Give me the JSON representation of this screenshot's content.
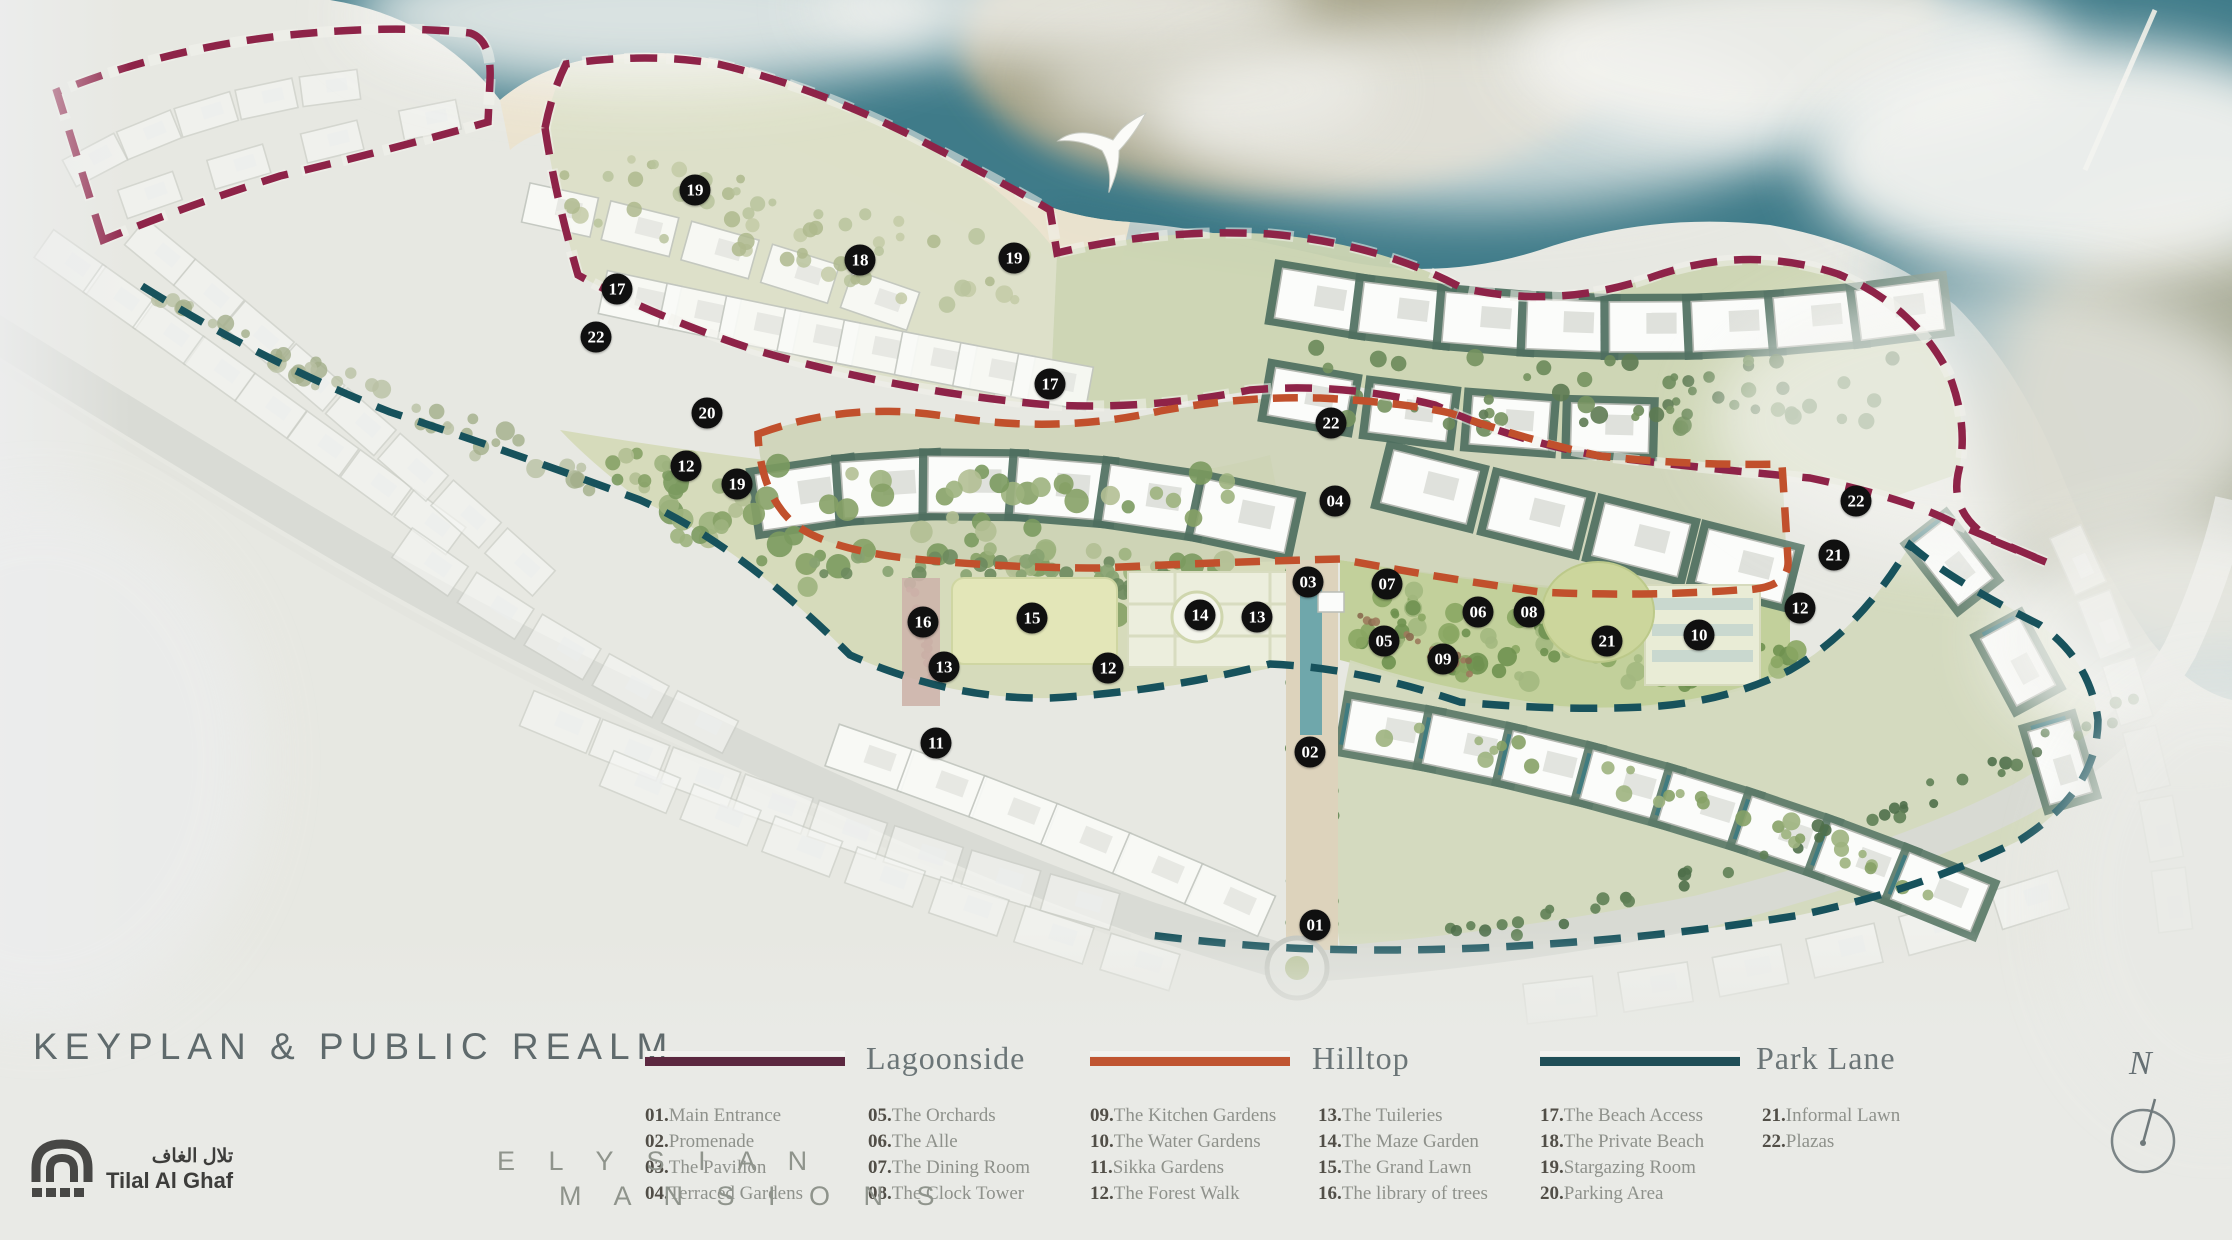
{
  "title": "KEYPLAN & PUBLIC REALM",
  "brand": {
    "logo_arabic": "تلال الغاف",
    "logo_name": "Tilal Al Ghaf",
    "project_line1": "E L Y S I A N",
    "project_line2": "M A N S I O N S"
  },
  "compass": {
    "label": "N"
  },
  "legend": {
    "groups": [
      {
        "id": "lagoonside",
        "name": "Lagoonside",
        "color": "#5c2840",
        "map_color": "#8e2348"
      },
      {
        "id": "hilltop",
        "name": "Hilltop",
        "color": "#c05531",
        "map_color": "#c1502c"
      },
      {
        "id": "parklane",
        "name": "Park Lane",
        "color": "#1f4e57",
        "map_color": "#17525c"
      }
    ],
    "columns": [
      [
        {
          "num": "01.",
          "label": "Main Entrance"
        },
        {
          "num": "02.",
          "label": "Promenade"
        },
        {
          "num": "03.",
          "label": "The Pavilion"
        },
        {
          "num": "04.",
          "label": "Terraced Gardens"
        }
      ],
      [
        {
          "num": "05.",
          "label": "The Orchards"
        },
        {
          "num": "06.",
          "label": "The Alle"
        },
        {
          "num": "07.",
          "label": "The Dining Room"
        },
        {
          "num": "08.",
          "label": "The Clock Tower"
        }
      ],
      [
        {
          "num": "09.",
          "label": "The Kitchen Gardens"
        },
        {
          "num": "10.",
          "label": "The Water Gardens"
        },
        {
          "num": "11.",
          "label": "Sikka Gardens"
        },
        {
          "num": "12.",
          "label": "The Forest Walk"
        }
      ],
      [
        {
          "num": "13.",
          "label": "The Tuileries"
        },
        {
          "num": "14.",
          "label": "The Maze Garden"
        },
        {
          "num": "15.",
          "label": "The Grand Lawn"
        },
        {
          "num": "16.",
          "label": "The library of trees"
        }
      ],
      [
        {
          "num": "17.",
          "label": "The Beach Access"
        },
        {
          "num": "18.",
          "label": "The Private Beach"
        },
        {
          "num": "19.",
          "label": "Stargazing Room"
        },
        {
          "num": "20.",
          "label": "Parking Area"
        }
      ],
      [
        {
          "num": "21.",
          "label": "Informal Lawn"
        },
        {
          "num": "22.",
          "label": "Plazas"
        }
      ]
    ]
  },
  "map": {
    "colors": {
      "water": "#3f7b89",
      "water_deep": "#2f6b78",
      "sand": "#a4a186",
      "beach": "#ebe3cd",
      "park": "#d6dbbb",
      "park_east": "#c2d09b",
      "road": "#d8dad4",
      "marker_bg": "#101010"
    },
    "markers": [
      {
        "n": "19",
        "x": 695,
        "y": 190
      },
      {
        "n": "18",
        "x": 860,
        "y": 260
      },
      {
        "n": "19",
        "x": 1014,
        "y": 258
      },
      {
        "n": "17",
        "x": 617,
        "y": 289
      },
      {
        "n": "22",
        "x": 596,
        "y": 337
      },
      {
        "n": "17",
        "x": 1050,
        "y": 384
      },
      {
        "n": "20",
        "x": 707,
        "y": 413
      },
      {
        "n": "22",
        "x": 1331,
        "y": 423
      },
      {
        "n": "12",
        "x": 686,
        "y": 466
      },
      {
        "n": "19",
        "x": 737,
        "y": 484
      },
      {
        "n": "04",
        "x": 1335,
        "y": 501
      },
      {
        "n": "22",
        "x": 1856,
        "y": 501
      },
      {
        "n": "21",
        "x": 1834,
        "y": 555
      },
      {
        "n": "03",
        "x": 1308,
        "y": 582
      },
      {
        "n": "07",
        "x": 1387,
        "y": 584
      },
      {
        "n": "12",
        "x": 1800,
        "y": 608
      },
      {
        "n": "06",
        "x": 1478,
        "y": 612
      },
      {
        "n": "08",
        "x": 1529,
        "y": 612
      },
      {
        "n": "14",
        "x": 1200,
        "y": 615
      },
      {
        "n": "13",
        "x": 1257,
        "y": 617
      },
      {
        "n": "15",
        "x": 1032,
        "y": 618
      },
      {
        "n": "16",
        "x": 923,
        "y": 622
      },
      {
        "n": "10",
        "x": 1699,
        "y": 635
      },
      {
        "n": "05",
        "x": 1384,
        "y": 641
      },
      {
        "n": "21",
        "x": 1607,
        "y": 641
      },
      {
        "n": "09",
        "x": 1443,
        "y": 659
      },
      {
        "n": "13",
        "x": 944,
        "y": 667
      },
      {
        "n": "12",
        "x": 1108,
        "y": 668
      },
      {
        "n": "11",
        "x": 936,
        "y": 743
      },
      {
        "n": "02",
        "x": 1310,
        "y": 752
      },
      {
        "n": "01",
        "x": 1315,
        "y": 925
      }
    ]
  }
}
